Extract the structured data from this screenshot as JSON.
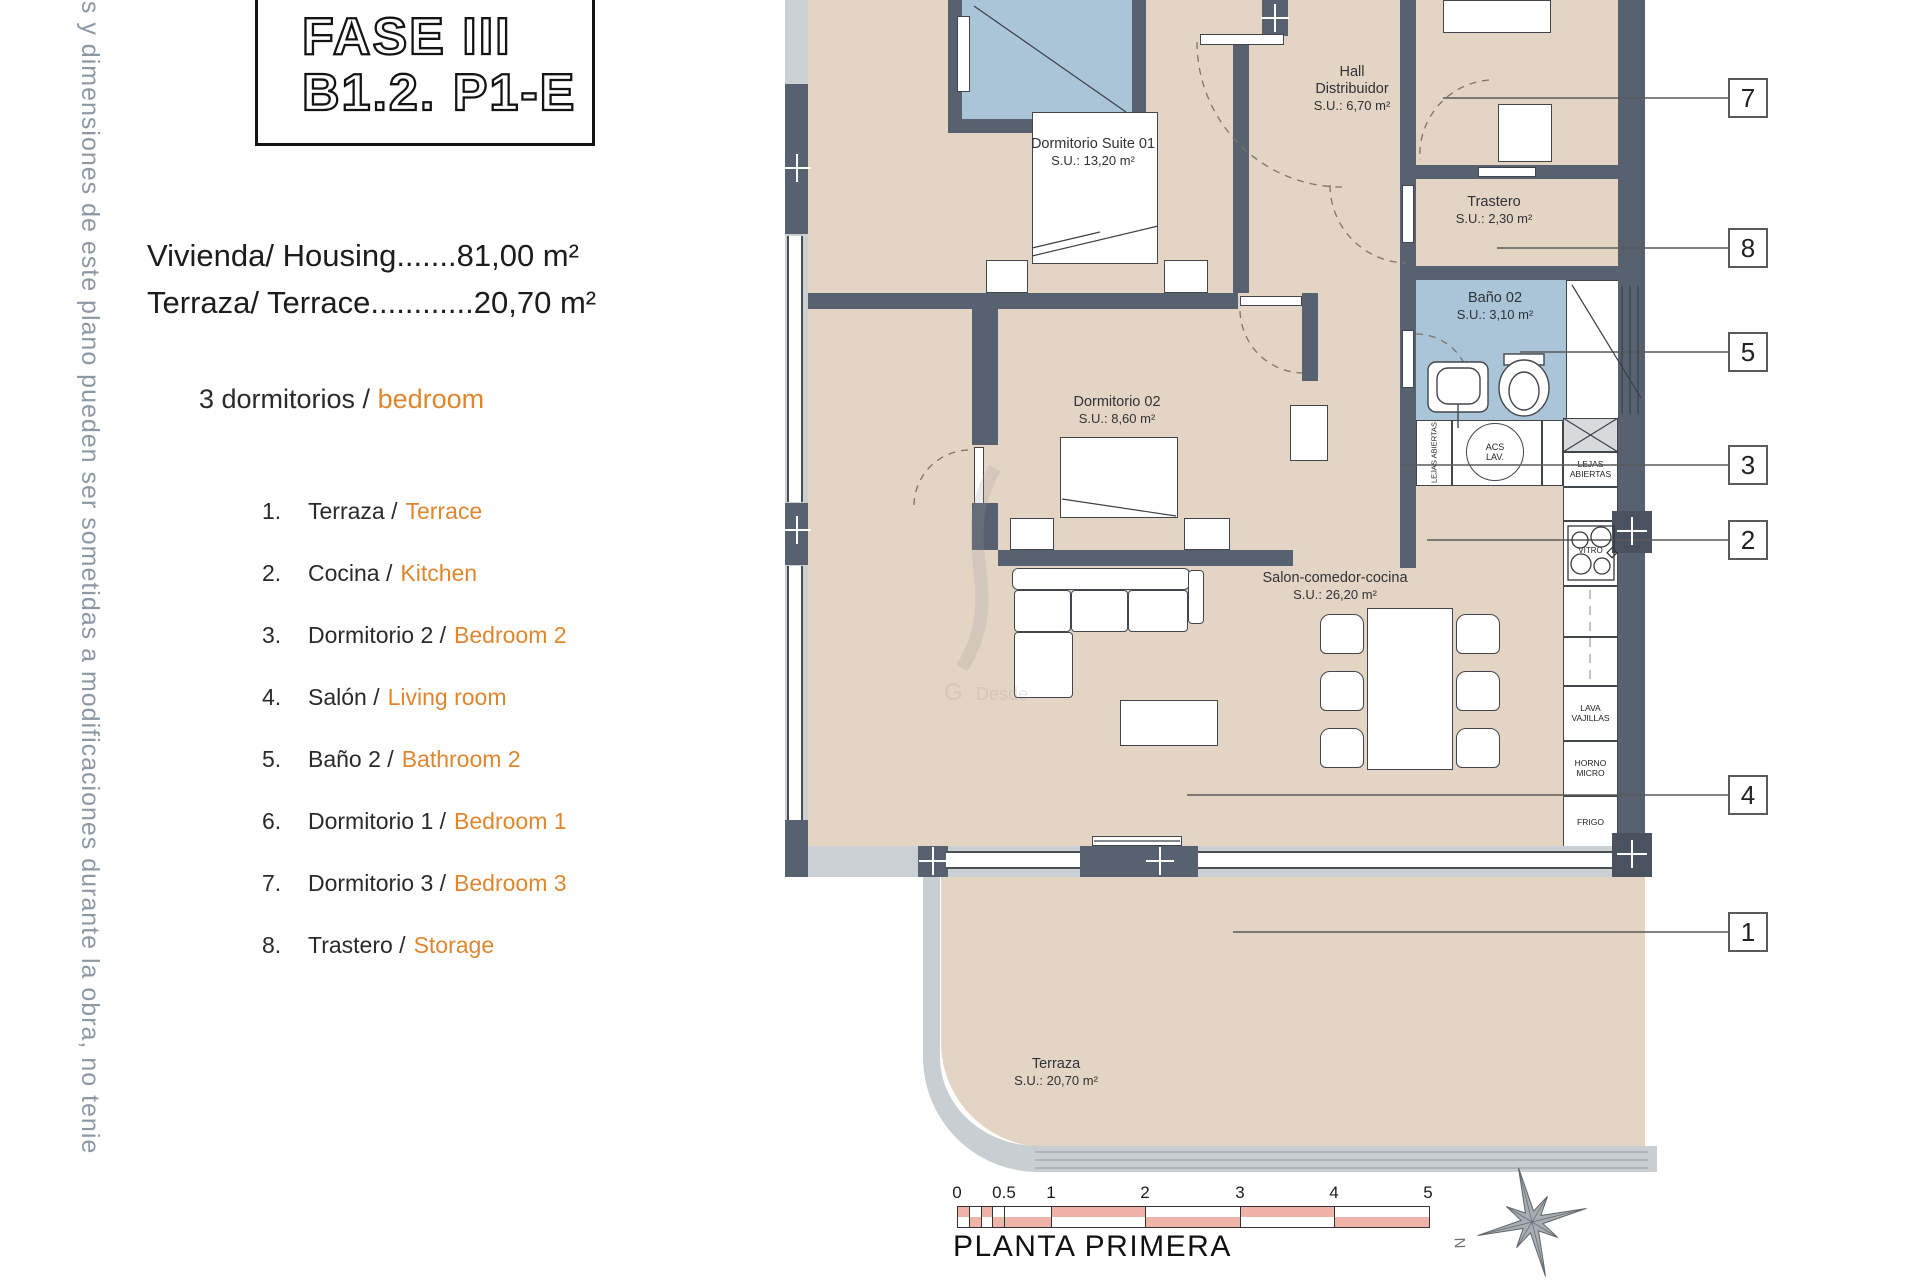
{
  "side_note": "es y dimensiones de este plano pueden ser sometidas a modificaciones durante la obra, no tenie",
  "title": {
    "line1": "FASE III",
    "line2": "B1.2. P1-E"
  },
  "summary": {
    "housing": "Vivienda/ Housing.......81,00 m²",
    "terrace": "Terraza/ Terrace............20,70 m²",
    "bedrooms_es": "3 dormitorios /",
    "bedrooms_en": "bedroom"
  },
  "legend": [
    {
      "num": "1.",
      "es": "Terraza /",
      "en": "Terrace"
    },
    {
      "num": "2.",
      "es": "Cocina /",
      "en": "Kitchen"
    },
    {
      "num": "3.",
      "es": "Dormitorio 2 /",
      "en": "Bedroom 2"
    },
    {
      "num": "4.",
      "es": "Salón /",
      "en": "Living room"
    },
    {
      "num": "5.",
      "es": "Baño 2 /",
      "en": "Bathroom 2"
    },
    {
      "num": "6.",
      "es": "Dormitorio 1 /",
      "en": "Bedroom 1"
    },
    {
      "num": "7.",
      "es": "Dormitorio 3 /",
      "en": "Bedroom 3"
    },
    {
      "num": "8.",
      "es": "Trastero /",
      "en": "Storage"
    }
  ],
  "rooms": {
    "suite01": {
      "name": "Dormitorio Suite 01",
      "area": "S.U.: 13,20 m²"
    },
    "hall": {
      "name": "Hall Distribuidor",
      "area": "S.U.: 6,70 m²"
    },
    "trastero": {
      "name": "Trastero",
      "area": "S.U.: 2,30 m²"
    },
    "bano02": {
      "name": "Baño 02",
      "area": "S.U.: 3,10 m²"
    },
    "dorm02": {
      "name": "Dormitorio 02",
      "area": "S.U.: 8,60 m²"
    },
    "salon": {
      "name": "Salon-comedor-cocina",
      "area": "S.U.: 26,20 m²"
    },
    "terraza": {
      "name": "Terraza",
      "area": "S.U.: 20,70 m²"
    }
  },
  "kitchen": {
    "shelf_left": "LEJAS ABIERTAS",
    "acs": "ACS LAV.",
    "shelf_right": "LEJAS ABIERTAS",
    "vitro": "VITRO",
    "dishwasher": "LAVA VAJILLAS",
    "oven": "HORNO MICRO",
    "fridge": "FRIGO"
  },
  "callouts": [
    "7",
    "8",
    "5",
    "3",
    "2",
    "4",
    "1"
  ],
  "scalebar": {
    "ticks": [
      "0",
      "0.5",
      "1",
      "2",
      "3",
      "4",
      "5"
    ]
  },
  "plan_title": "PLANTA PRIMERA",
  "compass": {
    "label": "N"
  },
  "colors": {
    "floor": "#e4d4c4",
    "wall": "#57616f",
    "window_band": "#cbd0d4",
    "wet_room": "#abc5d8",
    "accent": "#e0862e",
    "scalebar_pink": "#f0b3aa",
    "side_note": "#8d98a5"
  }
}
